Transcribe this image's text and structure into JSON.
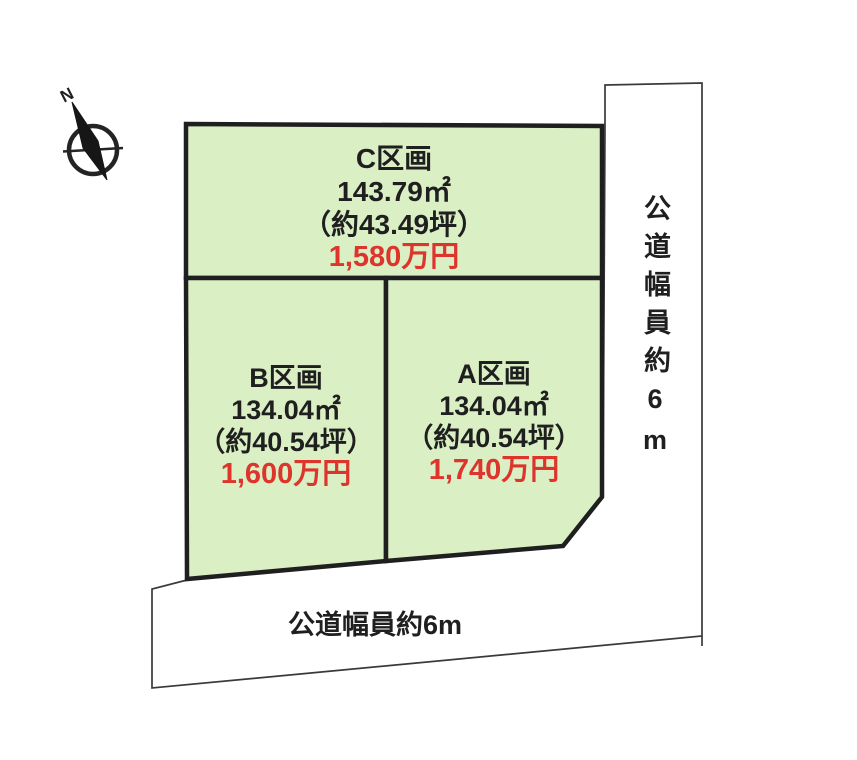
{
  "compass": {
    "north_label": "N"
  },
  "plots": [
    {
      "id": "C",
      "name": "C区画",
      "area_m2": "143.79㎡",
      "area_tsubo": "（約43.49坪）",
      "price": "1,580万円"
    },
    {
      "id": "B",
      "name": "B区画",
      "area_m2": "134.04㎡",
      "area_tsubo": "（約40.54坪）",
      "price": "1,600万円"
    },
    {
      "id": "A",
      "name": "A区画",
      "area_m2": "134.04㎡",
      "area_tsubo": "（約40.54坪）",
      "price": "1,740万円"
    }
  ],
  "roads": {
    "right_label": "公道幅員約6m",
    "bottom_label": "公道幅員約6m"
  },
  "colors": {
    "background": "#ffffff",
    "plot_fill": "#daefc4",
    "plot_border": "#1f1f1f",
    "price_color": "#dd342c",
    "road_line": "#3a3a3a"
  }
}
